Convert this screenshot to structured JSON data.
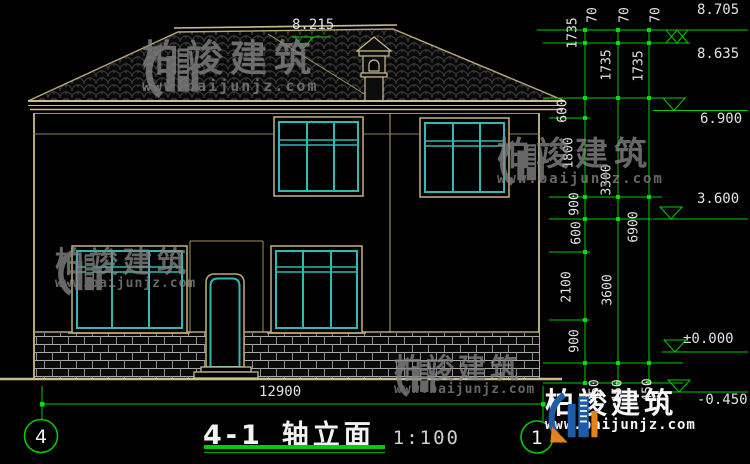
{
  "drawing": {
    "title_code": "4-1",
    "title_text": "轴立面",
    "scale": "1:100",
    "ridge_level_label": "8.215",
    "overall_width": "12900",
    "axis_bubbles": {
      "left": "4",
      "right": "1"
    }
  },
  "levels": {
    "ridge_top": "8.705",
    "ridge": "8.635",
    "eave": "6.900",
    "floor2": "3.600",
    "ground_floor": "±0.000",
    "grade": "-0.450"
  },
  "dims": {
    "v70": "70",
    "v1735": "1735",
    "v600": "600",
    "v1800": "1800",
    "v900": "900",
    "v2100": "2100",
    "v3300": "3300",
    "v3600": "3600",
    "v6900": "6900",
    "v450": "450"
  },
  "watermark": {
    "brand": "柏竣建筑",
    "site": "www.baijunjz.com"
  },
  "colors": {
    "background": "#000000",
    "line_tan": "#b9a878",
    "window_teal": "#2fb9b3",
    "dim_green": "#00cc00",
    "text": "#e2e2e2",
    "watermark_gray": "#858585",
    "logo_blue": "#1d5fae",
    "logo_orange": "#f08519"
  }
}
